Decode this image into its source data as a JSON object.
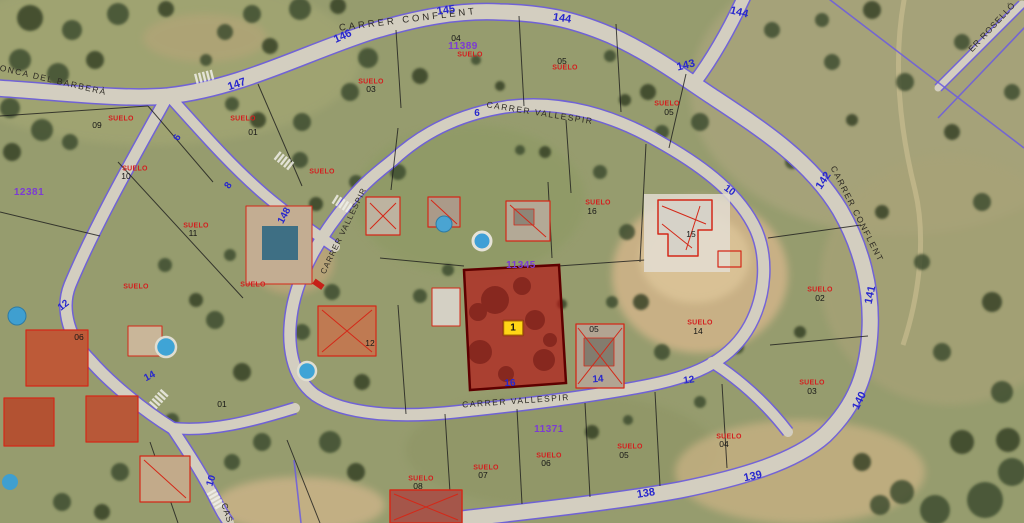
{
  "viewer": {
    "description": "Aerial cadastral map with parcel overlay",
    "selected_parcel_badge": "1"
  },
  "colors": {
    "street_number": "#2727cd",
    "zone_ref": "#7c3bd3",
    "parcel_number": "#161616",
    "construction": "#d31f1f",
    "street_name": "#2e2b24",
    "highlight_fill": "#b41414",
    "highlight_border": "#5e0000",
    "badge_bg": "#ffd616",
    "road_boundary": "#6c5ce0",
    "parcel_line": "#1c1c1c"
  },
  "labels": {
    "street_names": [
      {
        "t": "CARRER CONFLENT",
        "x": 408,
        "y": 20,
        "r": -7,
        "ls": 3,
        "fs": 9.5
      },
      {
        "t": "R CONCA DEL BARBERÀ",
        "x": 44,
        "y": 78,
        "r": 13,
        "ls": 1.5
      },
      {
        "t": "CARRER VALLESPIR",
        "x": 540,
        "y": 113,
        "r": 9,
        "ls": 1.5
      },
      {
        "t": "CARRER VALLESPIR",
        "x": 516,
        "y": 401,
        "r": -4,
        "ls": 1.5
      },
      {
        "t": "CARRER CONFLENT",
        "x": 857,
        "y": 214,
        "r": 63,
        "ls": 1.5
      },
      {
        "t": "ER ROSELLÓ",
        "x": 992,
        "y": 27,
        "r": -47,
        "ls": 1
      },
      {
        "t": "CARRER VALLESPIR",
        "x": 344,
        "y": 231,
        "r": -64,
        "ls": 1,
        "fs": 8
      },
      {
        "t": "CAS",
        "x": 227,
        "y": 513,
        "r": 72,
        "ls": 1
      }
    ],
    "street_numbers": [
      {
        "t": "147",
        "x": 237,
        "y": 85,
        "r": -18
      },
      {
        "t": "146",
        "x": 343,
        "y": 37,
        "r": -24
      },
      {
        "t": "145",
        "x": 446,
        "y": 11,
        "r": -8
      },
      {
        "t": "144",
        "x": 562,
        "y": 19,
        "r": 8
      },
      {
        "t": "144",
        "x": 739,
        "y": 13,
        "r": 14
      },
      {
        "t": "143",
        "x": 686,
        "y": 66,
        "r": -14
      },
      {
        "t": "142",
        "x": 824,
        "y": 181,
        "r": -56
      },
      {
        "t": "141",
        "x": 871,
        "y": 295,
        "r": -78
      },
      {
        "t": "140",
        "x": 860,
        "y": 401,
        "r": -64
      },
      {
        "t": "139",
        "x": 753,
        "y": 477,
        "r": -12
      },
      {
        "t": "138",
        "x": 646,
        "y": 494,
        "r": -9
      },
      {
        "t": "10",
        "x": 729,
        "y": 191,
        "r": 36,
        "fs": 10
      },
      {
        "t": "6",
        "x": 477,
        "y": 114,
        "r": 0,
        "fs": 10
      },
      {
        "t": "8",
        "x": 229,
        "y": 186,
        "r": -56,
        "fs": 10
      },
      {
        "t": "6",
        "x": 178,
        "y": 138,
        "r": -62,
        "fs": 10
      },
      {
        "t": "148",
        "x": 285,
        "y": 216,
        "r": -62,
        "fs": 10
      },
      {
        "t": "12",
        "x": 64,
        "y": 306,
        "r": -38,
        "fs": 10
      },
      {
        "t": "14",
        "x": 150,
        "y": 377,
        "r": -28,
        "fs": 10
      },
      {
        "t": "10",
        "x": 212,
        "y": 481,
        "r": -72,
        "fs": 10
      },
      {
        "t": "16",
        "x": 510,
        "y": 384,
        "r": -3,
        "fs": 10
      },
      {
        "t": "14",
        "x": 598,
        "y": 380,
        "r": -4,
        "fs": 10
      },
      {
        "t": "12",
        "x": 689,
        "y": 381,
        "r": -8,
        "fs": 10
      }
    ],
    "zone_refs": [
      {
        "t": "12381",
        "x": 29,
        "y": 193
      },
      {
        "t": "11389",
        "x": 463,
        "y": 47
      },
      {
        "t": "11345",
        "x": 521,
        "y": 266
      },
      {
        "t": "11371",
        "x": 549,
        "y": 430
      }
    ],
    "parcel_numbers": [
      {
        "t": "09",
        "x": 97,
        "y": 125
      },
      {
        "t": "01",
        "x": 253,
        "y": 132
      },
      {
        "t": "10",
        "x": 126,
        "y": 176
      },
      {
        "t": "11",
        "x": 193,
        "y": 233
      },
      {
        "t": "03",
        "x": 371,
        "y": 89
      },
      {
        "t": "04",
        "x": 456,
        "y": 38
      },
      {
        "t": "05",
        "x": 562,
        "y": 61
      },
      {
        "t": "05",
        "x": 669,
        "y": 112
      },
      {
        "t": "16",
        "x": 592,
        "y": 211
      },
      {
        "t": "15",
        "x": 691,
        "y": 234
      },
      {
        "t": "05",
        "x": 594,
        "y": 329
      },
      {
        "t": "12",
        "x": 370,
        "y": 343
      },
      {
        "t": "14",
        "x": 698,
        "y": 331
      },
      {
        "t": "02",
        "x": 820,
        "y": 298
      },
      {
        "t": "03",
        "x": 812,
        "y": 391
      },
      {
        "t": "04",
        "x": 724,
        "y": 444
      },
      {
        "t": "05",
        "x": 624,
        "y": 455
      },
      {
        "t": "06",
        "x": 546,
        "y": 463
      },
      {
        "t": "07",
        "x": 483,
        "y": 475
      },
      {
        "t": "08",
        "x": 418,
        "y": 486
      },
      {
        "t": "01",
        "x": 222,
        "y": 404
      },
      {
        "t": "06",
        "x": 79,
        "y": 337
      }
    ],
    "construction_labels": [
      {
        "t": "SUELO",
        "x": 121,
        "y": 119
      },
      {
        "t": "SUELO",
        "x": 243,
        "y": 119
      },
      {
        "t": "SUELO",
        "x": 135,
        "y": 169
      },
      {
        "t": "SUELO",
        "x": 196,
        "y": 226
      },
      {
        "t": "SUELO",
        "x": 371,
        "y": 82
      },
      {
        "t": "SUELO",
        "x": 470,
        "y": 55
      },
      {
        "t": "SUELO",
        "x": 565,
        "y": 68
      },
      {
        "t": "SUELO",
        "x": 667,
        "y": 104
      },
      {
        "t": "SUELO",
        "x": 598,
        "y": 203
      },
      {
        "t": "SUELO",
        "x": 322,
        "y": 172
      },
      {
        "t": "SUELO",
        "x": 253,
        "y": 285
      },
      {
        "t": "SUELO",
        "x": 136,
        "y": 287
      },
      {
        "t": "SUELO",
        "x": 820,
        "y": 290
      },
      {
        "t": "SUELO",
        "x": 700,
        "y": 323
      },
      {
        "t": "SUELO",
        "x": 812,
        "y": 383
      },
      {
        "t": "SUELO",
        "x": 729,
        "y": 437
      },
      {
        "t": "SUELO",
        "x": 630,
        "y": 447
      },
      {
        "t": "SUELO",
        "x": 549,
        "y": 456
      },
      {
        "t": "SUELO",
        "x": 486,
        "y": 468
      },
      {
        "t": "SUELO",
        "x": 421,
        "y": 479
      }
    ]
  }
}
